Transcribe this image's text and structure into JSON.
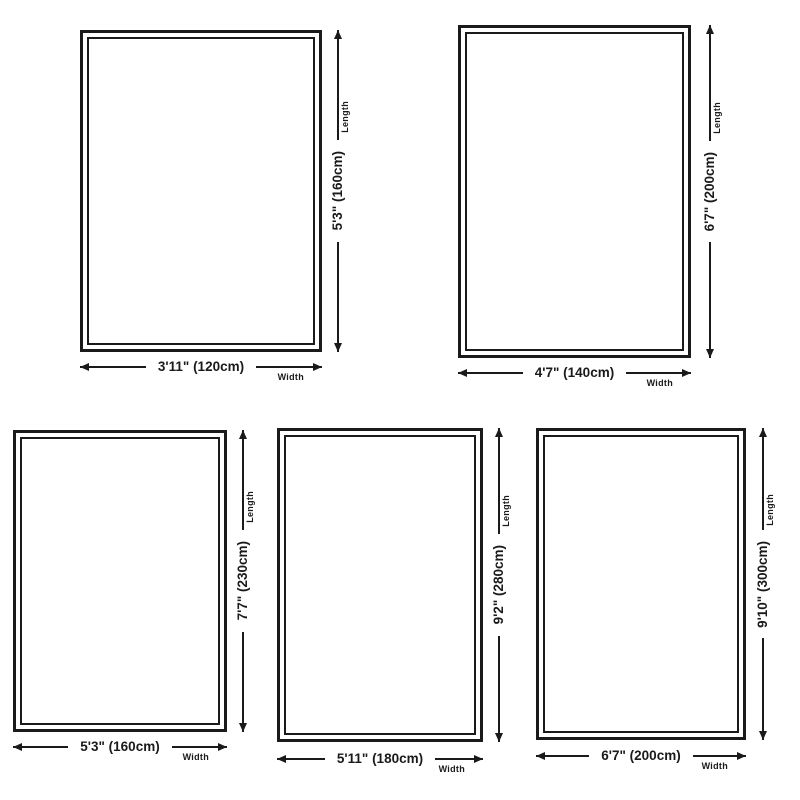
{
  "colors": {
    "line": "#1a1a1a",
    "text": "#1a1a1a",
    "background": "#ffffff"
  },
  "rugs": [
    {
      "name": "rug-size-120x160",
      "length_value": "5'3\" (160cm)",
      "width_value": "3'11\" (120cm)",
      "length_label": "Length",
      "width_label": "Width"
    },
    {
      "name": "rug-size-140x200",
      "length_value": "6'7\" (200cm)",
      "width_value": "4'7\" (140cm)",
      "length_label": "Length",
      "width_label": "Width"
    },
    {
      "name": "rug-size-160x230",
      "length_value": "7'7\" (230cm)",
      "width_value": "5'3\" (160cm)",
      "length_label": "Length",
      "width_label": "Width"
    },
    {
      "name": "rug-size-180x280",
      "length_value": "9'2\" (280cm)",
      "width_value": "5'11\" (180cm)",
      "length_label": "Length",
      "width_label": "Width"
    },
    {
      "name": "rug-size-200x300",
      "length_value": "9'10\" (300cm)",
      "width_value": "6'7\" (200cm)",
      "length_label": "Length",
      "width_label": "Width"
    }
  ]
}
